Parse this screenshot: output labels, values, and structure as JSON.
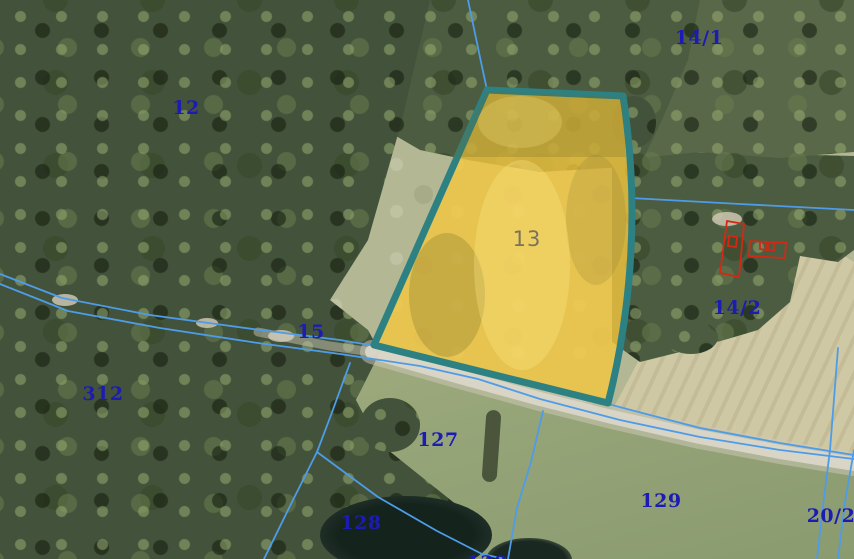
{
  "map": {
    "kind": "cadastral-orthophoto-view",
    "selected_parcel": {
      "label": "13"
    }
  },
  "colors": {
    "parcel_fill": "#f4c73e",
    "parcel_border": "#2d8183",
    "boundary_line": "#4e9ce8",
    "parcel_label": "#1c1cb4",
    "selected_label": "#6e685a",
    "building_outline": "#d42814"
  },
  "labels": [
    {
      "id": "14-1",
      "text": "14/1",
      "x": 699,
      "y": 38,
      "type": "parcel"
    },
    {
      "id": "12",
      "text": "12",
      "x": 186,
      "y": 108,
      "type": "parcel"
    },
    {
      "id": "13",
      "text": "13",
      "x": 527,
      "y": 239,
      "type": "selected"
    },
    {
      "id": "14-2",
      "text": "14/2",
      "x": 737,
      "y": 308,
      "type": "parcel"
    },
    {
      "id": "15",
      "text": "15",
      "x": 311,
      "y": 332,
      "type": "parcel"
    },
    {
      "id": "312",
      "text": "312",
      "x": 103,
      "y": 394,
      "type": "parcel"
    },
    {
      "id": "127",
      "text": "127",
      "x": 438,
      "y": 440,
      "type": "parcel"
    },
    {
      "id": "128",
      "text": "128",
      "x": 361,
      "y": 523,
      "type": "parcel"
    },
    {
      "id": "129",
      "text": "129",
      "x": 661,
      "y": 501,
      "type": "parcel"
    },
    {
      "id": "20-2",
      "text": "20/2",
      "x": 831,
      "y": 516,
      "type": "parcel"
    },
    {
      "id": "130",
      "text": "130",
      "x": 487,
      "y": 563,
      "type": "parcel"
    }
  ]
}
